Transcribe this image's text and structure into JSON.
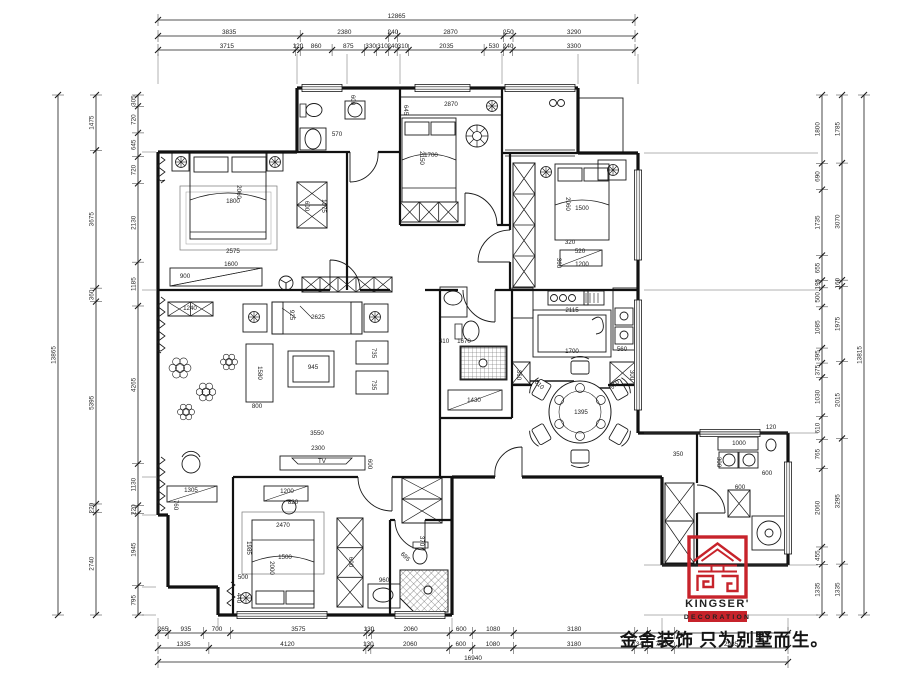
{
  "meta": {
    "background": "#ffffff",
    "line_color": "#1a1a1a",
    "accent_red": "#c7232b",
    "drawing_type": "residential floor plan"
  },
  "logo": {
    "brand": "KINGSER'",
    "sub": "DECORATION"
  },
  "slogan": "金舍装饰 只为别墅而生。",
  "dimension_chains": [
    {
      "name": "top-overall",
      "v": [
        12865
      ],
      "t": [
        "12865"
      ]
    },
    {
      "name": "top-outer",
      "v": [
        3835,
        2380,
        240,
        2870,
        250,
        3290
      ],
      "t": [
        "3835",
        "2380",
        "240",
        "2870",
        "250",
        "3290"
      ]
    },
    {
      "name": "top-inner",
      "v": [
        3715,
        120,
        860,
        875,
        330,
        310,
        240,
        310,
        2035,
        530,
        240,
        3300
      ],
      "t": [
        "3715",
        "120",
        "860",
        "875",
        "330",
        "310",
        "240",
        "310",
        "2035",
        "530",
        "240",
        "3300"
      ]
    },
    {
      "name": "left-overall",
      "v": [
        13865
      ],
      "t": [
        "13865"
      ]
    },
    {
      "name": "left-outer",
      "v": [
        1475,
        3675,
        360,
        5395,
        220,
        2740
      ],
      "t": [
        "1475",
        "3675",
        "360",
        "5395",
        "220",
        "2740"
      ]
    },
    {
      "name": "left-inner",
      "v": [
        305,
        720,
        645,
        720,
        2130,
        1185,
        4265,
        1130,
        220,
        1945,
        795
      ],
      "t": [
        "305",
        "720",
        "645",
        "720",
        "2130",
        "1185",
        "4265",
        "1130",
        "220",
        "1945",
        "795"
      ]
    },
    {
      "name": "right-inner",
      "v": [
        1800,
        690,
        1735,
        655,
        195,
        500,
        1085,
        395,
        375,
        1030,
        610,
        765,
        2060,
        455,
        1335
      ],
      "t": [
        "1800",
        "690",
        "1735",
        "655",
        "195",
        "500",
        "1085",
        "395",
        "375",
        "1030",
        "610",
        "765",
        "2060",
        "455",
        "1335"
      ]
    },
    {
      "name": "right-outer",
      "v": [
        1785,
        3070,
        160,
        1975,
        2015,
        3295,
        1335
      ],
      "t": [
        "1785",
        "3070",
        "160",
        "1975",
        "2015",
        "3295",
        "1335"
      ]
    },
    {
      "name": "right-overall",
      "v": [
        13815
      ],
      "t": [
        "13815"
      ]
    },
    {
      "name": "bottom-inner",
      "v": [
        265,
        935,
        700,
        3575,
        130,
        2060,
        600,
        1080,
        3180,
        340,
        700,
        2985
      ],
      "t": [
        "265",
        "935",
        "700",
        "3575",
        "130",
        "2060",
        "600",
        "1080",
        "3180",
        "",
        "",
        ""
      ]
    },
    {
      "name": "bottom-outer",
      "v": [
        1335,
        4120,
        130,
        2060,
        600,
        1080,
        3180,
        340,
        700,
        2985
      ],
      "t": [
        "1335",
        "4120",
        "130",
        "2060",
        "600",
        "1080",
        "3180",
        "340",
        "700",
        "2985"
      ]
    },
    {
      "name": "bottom-overall",
      "v": [
        16940
      ],
      "t": [
        "16940"
      ]
    }
  ],
  "plan_labels": [
    {
      "t": "2060",
      "x": 237,
      "y": 192,
      "r": 90
    },
    {
      "t": "1800",
      "x": 233,
      "y": 203
    },
    {
      "t": "2575",
      "x": 233,
      "y": 253
    },
    {
      "t": "1600",
      "x": 231,
      "y": 266
    },
    {
      "t": "900",
      "x": 185,
      "y": 278
    },
    {
      "t": "600",
      "x": 305,
      "y": 206,
      "r": 90
    },
    {
      "t": "1075",
      "x": 322,
      "y": 206,
      "r": 90
    },
    {
      "t": "570",
      "x": 337,
      "y": 136
    },
    {
      "t": "600",
      "x": 351,
      "y": 100,
      "r": 90
    },
    {
      "t": "2870",
      "x": 451,
      "y": 106
    },
    {
      "t": "645",
      "x": 404,
      "y": 110,
      "r": 90
    },
    {
      "t": "1700",
      "x": 431,
      "y": 157
    },
    {
      "t": "2150",
      "x": 420,
      "y": 158,
      "r": 90
    },
    {
      "t": "2060",
      "x": 566,
      "y": 204,
      "r": 90
    },
    {
      "t": "1500",
      "x": 582,
      "y": 210
    },
    {
      "t": "320",
      "x": 570,
      "y": 244
    },
    {
      "t": "520",
      "x": 580,
      "y": 253
    },
    {
      "t": "1200",
      "x": 582,
      "y": 266
    },
    {
      "t": "360",
      "x": 557,
      "y": 263,
      "r": 90
    },
    {
      "t": "1240",
      "x": 190,
      "y": 310
    },
    {
      "t": "925",
      "x": 290,
      "y": 315,
      "r": 90
    },
    {
      "t": "2625",
      "x": 318,
      "y": 319
    },
    {
      "t": "945",
      "x": 313,
      "y": 369
    },
    {
      "t": "1580",
      "x": 258,
      "y": 373,
      "r": 90
    },
    {
      "t": "735",
      "x": 372,
      "y": 353,
      "r": 90
    },
    {
      "t": "735",
      "x": 372,
      "y": 385,
      "r": 90
    },
    {
      "t": "800",
      "x": 257,
      "y": 408
    },
    {
      "t": "3550",
      "x": 317,
      "y": 435
    },
    {
      "t": "2300",
      "x": 318,
      "y": 450
    },
    {
      "t": "TV",
      "x": 322,
      "y": 463
    },
    {
      "t": "600",
      "x": 368,
      "y": 464,
      "r": 90
    },
    {
      "t": "2115",
      "x": 572,
      "y": 312
    },
    {
      "t": "1700",
      "x": 572,
      "y": 353
    },
    {
      "t": "560",
      "x": 622,
      "y": 351
    },
    {
      "t": "360",
      "x": 517,
      "y": 375,
      "r": 90
    },
    {
      "t": "300",
      "x": 630,
      "y": 375,
      "r": 90
    },
    {
      "t": "1395",
      "x": 581,
      "y": 414
    },
    {
      "t": "510",
      "x": 538,
      "y": 386,
      "r": 45
    },
    {
      "t": "510",
      "x": 616,
      "y": 386,
      "r": -45
    },
    {
      "t": "410",
      "x": 444,
      "y": 343
    },
    {
      "t": "1670",
      "x": 464,
      "y": 343
    },
    {
      "t": "1430",
      "x": 474,
      "y": 402
    },
    {
      "t": "2470",
      "x": 283,
      "y": 527
    },
    {
      "t": "1985",
      "x": 247,
      "y": 548,
      "r": 90
    },
    {
      "t": "1500",
      "x": 285,
      "y": 559
    },
    {
      "t": "2000",
      "x": 270,
      "y": 568,
      "r": 90
    },
    {
      "t": "1200",
      "x": 287,
      "y": 493
    },
    {
      "t": "820",
      "x": 293,
      "y": 504
    },
    {
      "t": "600",
      "x": 349,
      "y": 562,
      "r": 90
    },
    {
      "t": "1305",
      "x": 191,
      "y": 492
    },
    {
      "t": "760",
      "x": 174,
      "y": 505,
      "r": 90
    },
    {
      "t": "500",
      "x": 243,
      "y": 579
    },
    {
      "t": "440",
      "x": 237,
      "y": 598,
      "r": 90
    },
    {
      "t": "960",
      "x": 384,
      "y": 582
    },
    {
      "t": "370",
      "x": 420,
      "y": 541,
      "r": 90
    },
    {
      "t": "695",
      "x": 404,
      "y": 558,
      "r": 45
    },
    {
      "t": "1000",
      "x": 739,
      "y": 445
    },
    {
      "t": "120",
      "x": 771,
      "y": 429
    },
    {
      "t": "300",
      "x": 717,
      "y": 462,
      "r": 90
    },
    {
      "t": "600",
      "x": 767,
      "y": 475
    },
    {
      "t": "600",
      "x": 740,
      "y": 489
    },
    {
      "t": "350",
      "x": 678,
      "y": 456
    }
  ]
}
